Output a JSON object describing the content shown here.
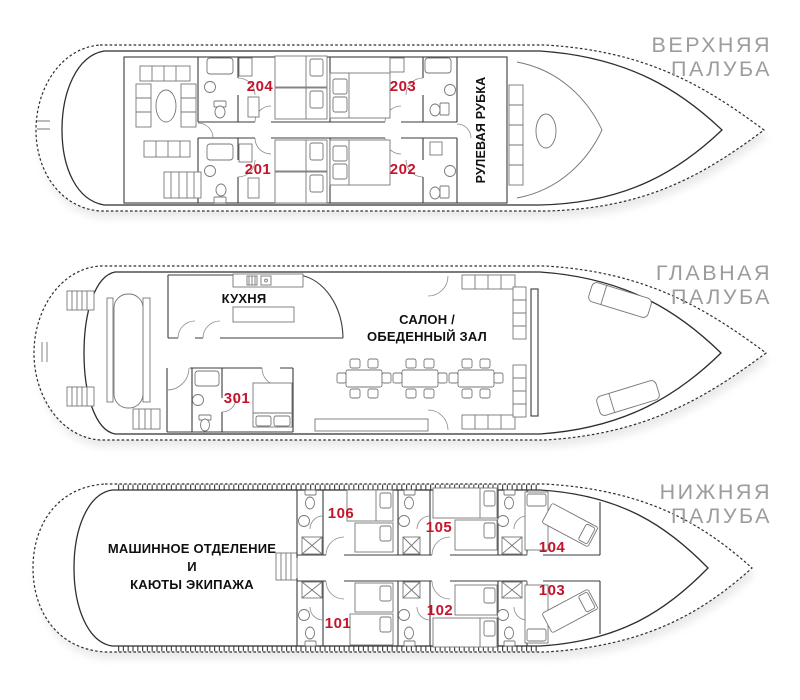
{
  "colors": {
    "cabin_number": "#C5132B",
    "deck_label": "#9C9C9C",
    "outline": "#2E2E2E",
    "wall": "#3B3B3B",
    "furniture": "#777777",
    "label_text": "#101010",
    "background": "#FFFFFF"
  },
  "decks": {
    "upper": {
      "name_line1": "ВЕРХНЯЯ",
      "name_line2": "ПАЛУБА",
      "wheelhouse_label": "РУЛЕВАЯ РУБКА",
      "cabins": {
        "c204": "204",
        "c203": "203",
        "c201": "201",
        "c202": "202"
      }
    },
    "main": {
      "name_line1": "ГЛАВНАЯ",
      "name_line2": "ПАЛУБА",
      "kitchen_label": "КУХНЯ",
      "salon_line1": "САЛОН /",
      "salon_line2": "ОБЕДЕННЫЙ ЗАЛ",
      "cabins": {
        "c301": "301"
      }
    },
    "lower": {
      "name_line1": "НИЖНЯЯ",
      "name_line2": "ПАЛУБА",
      "engine_line1": "МАШИННОЕ ОТДЕЛЕНИЕ",
      "engine_line2": "И",
      "engine_line3": "КАЮТЫ ЭКИПАЖА",
      "cabins": {
        "c106": "106",
        "c105": "105",
        "c104": "104",
        "c103": "103",
        "c102": "102",
        "c101": "101"
      }
    }
  }
}
